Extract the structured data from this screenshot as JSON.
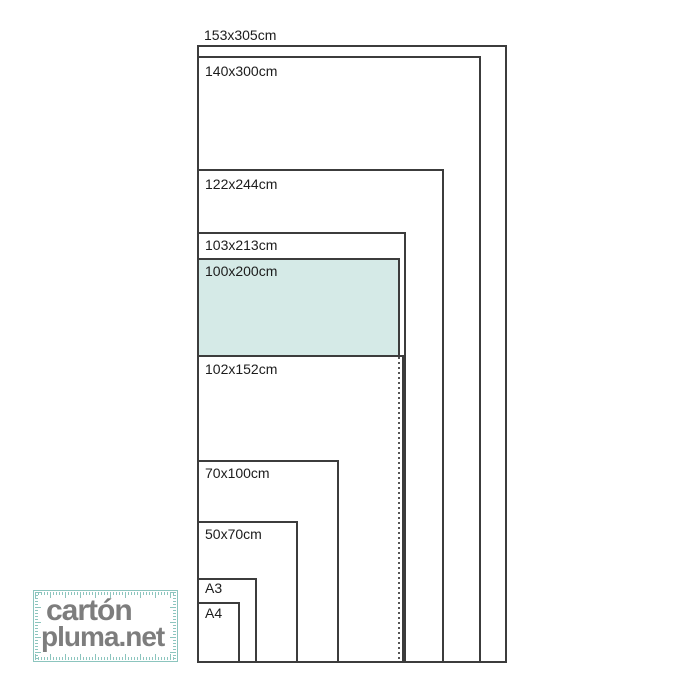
{
  "diagram": {
    "description": "foam-board size comparison, nested rectangles sharing bottom-left corner",
    "unit": "cm",
    "sizes": [
      {
        "label": "153x305cm",
        "width_cm": 153,
        "height_cm": 305,
        "highlighted": false
      },
      {
        "label": "140x300cm",
        "width_cm": 140,
        "height_cm": 300,
        "highlighted": false
      },
      {
        "label": "122x244cm",
        "width_cm": 122,
        "height_cm": 244,
        "highlighted": false
      },
      {
        "label": "103x213cm",
        "width_cm": 103,
        "height_cm": 213,
        "highlighted": false
      },
      {
        "label": "100x200cm",
        "width_cm": 100,
        "height_cm": 200,
        "highlighted": true
      },
      {
        "label": "102x152cm",
        "width_cm": 102,
        "height_cm": 152,
        "highlighted": false
      },
      {
        "label": "70x100cm",
        "width_cm": 70,
        "height_cm": 100,
        "highlighted": false
      },
      {
        "label": "50x70cm",
        "width_cm": 50,
        "height_cm": 70,
        "highlighted": false
      },
      {
        "label": "A3",
        "highlighted": false
      },
      {
        "label": "A4",
        "highlighted": false
      }
    ],
    "colors": {
      "highlight_fill": "#d5eae7",
      "outline": "#3c3c3c",
      "label_text": "#1c1c1c",
      "hidden_edge_dotted": "#555555"
    }
  },
  "logo": {
    "line1": "cartón",
    "line2": "pluma.net",
    "colors": {
      "text": "#7d7d7d",
      "ruler_frame": "#8cc5be"
    }
  }
}
